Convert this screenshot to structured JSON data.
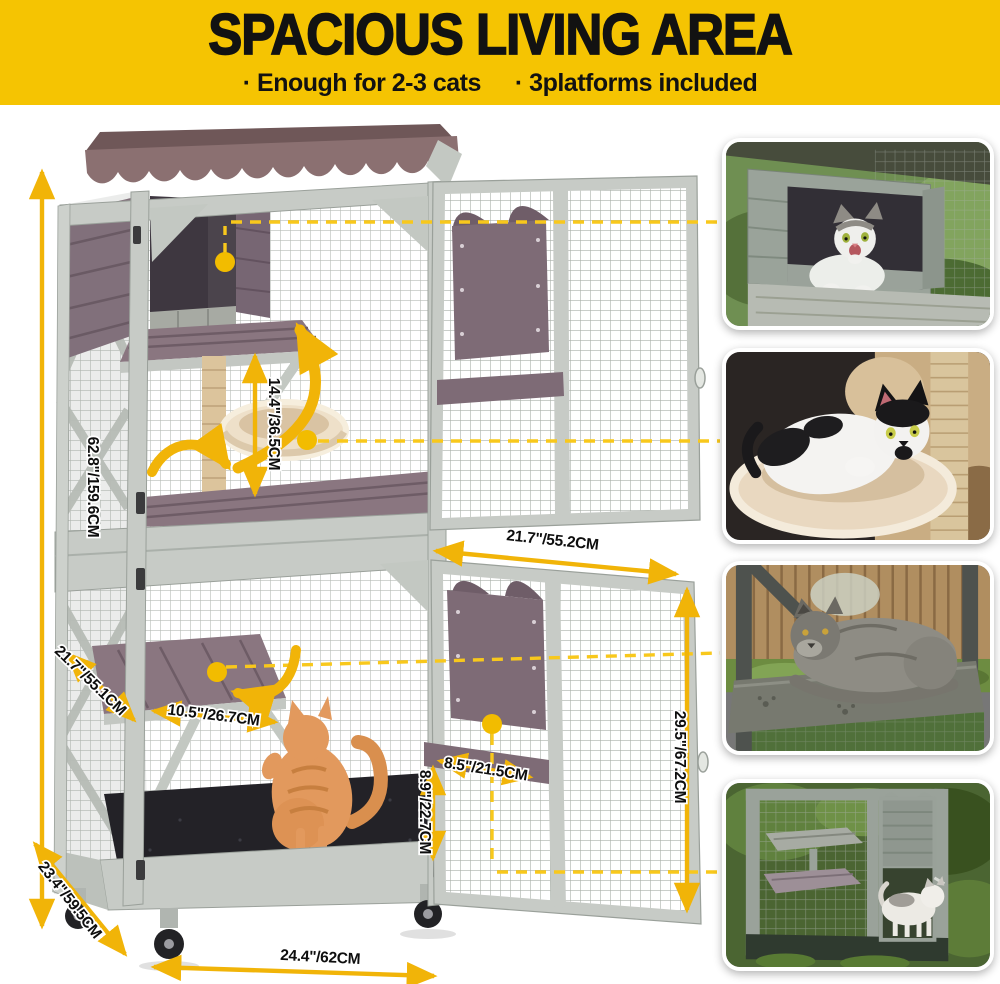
{
  "header": {
    "title": "SPACIOUS LIVING AREA",
    "bullet1": "· Enough for 2-3 cats",
    "bullet2": "· 3platforms included",
    "bg": "#F5C402",
    "fg": "#121212"
  },
  "dimensions": {
    "total_height": "62.8\"/159.6CM",
    "hammock_clearance": "14.4\"/36.5CM",
    "door_width": "21.7\"/55.2CM",
    "platform_depth": "21.7\"/55.1CM",
    "platform_width": "10.5\"/26.7CM",
    "door_height": "29.5\"/67.2CM",
    "cat_door_width": "8.5\"/21.5CM",
    "cat_door_height": "8.9\"/22.7CM",
    "base_depth": "23.4\"/59.5CM",
    "base_width": "24.4\"/62CM"
  },
  "colors": {
    "accent_arrow": "#F1B408",
    "dashed_line": "#F8C81C",
    "wood_trim": "#8A7680",
    "frame_gray": "#C7CBC6",
    "roof": "#8B7071"
  },
  "insets": [
    {
      "alt": "Cat peeking out of the wooden cat house"
    },
    {
      "alt": "Black and white cat curled in the plush hammock"
    },
    {
      "alt": "Gray cat lounging on the outdoor platform"
    },
    {
      "alt": "Cat standing at the open cat door of the enclosure"
    }
  ]
}
